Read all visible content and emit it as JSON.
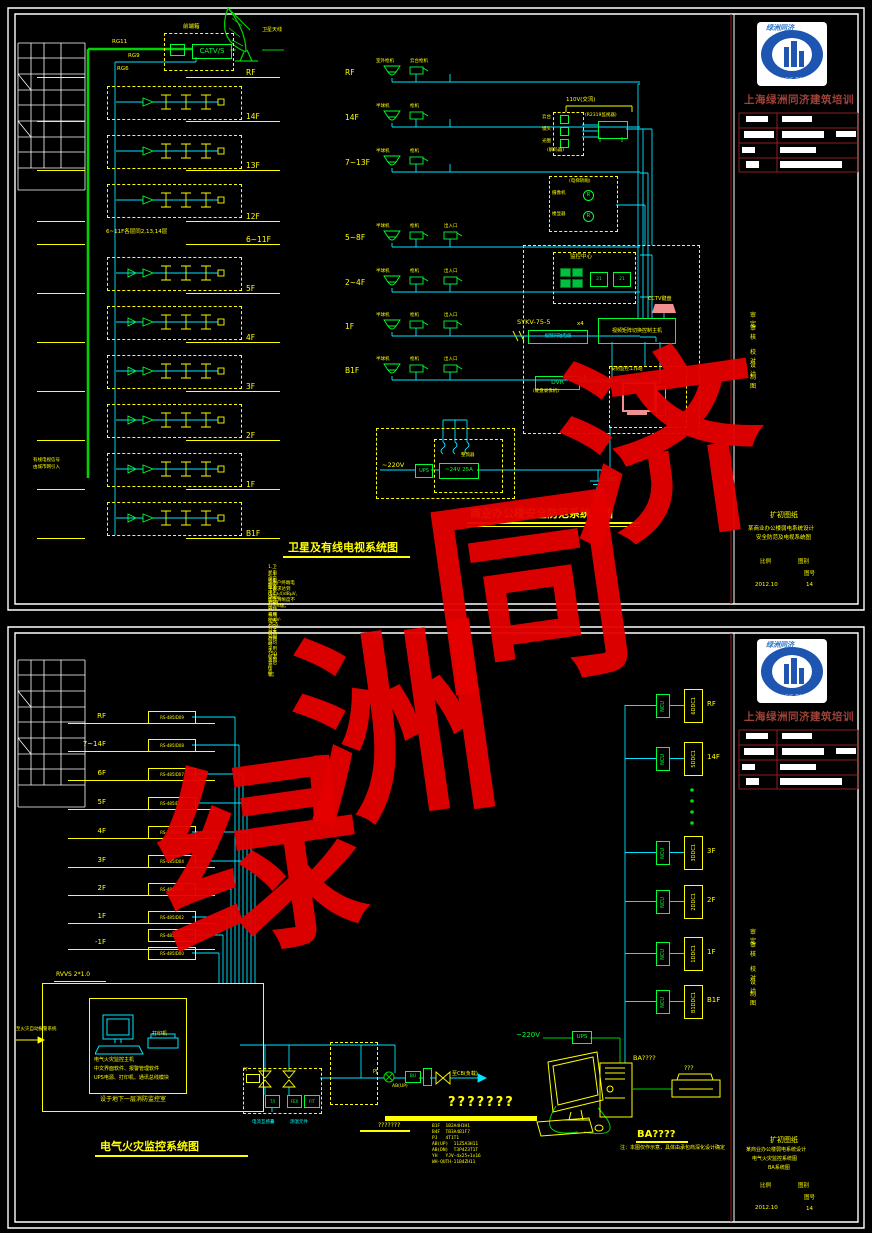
{
  "company": "上海绿洲同济建筑培训",
  "logo": {
    "script_text": "绿洲同济",
    "arc_text": "OASIS TONGJI"
  },
  "tb": {
    "stage": "扩初图纸",
    "scale_label": "比例",
    "type_label": "图别",
    "no_label": "图号",
    "date": "2012.10",
    "page": "14"
  },
  "tb1": {
    "line1": "某商业办公楼弱电系统设计",
    "line2": "安全防范及电视系统图"
  },
  "tb2": {
    "line1": "某商业办公楼弱电系统设计",
    "line2": "电气火灾监控系统图",
    "line3": "BA系统图"
  },
  "tb_labels": [
    {
      "x": 750,
      "y": 310,
      "label": "审定"
    },
    {
      "x": 750,
      "y": 323,
      "label": "审核"
    },
    {
      "x": 750,
      "y": 347,
      "label": "校对"
    },
    {
      "x": 750,
      "y": 360,
      "label": "设计"
    },
    {
      "x": 750,
      "y": 372,
      "label": "制图"
    },
    {
      "x": 750,
      "y": 927,
      "label": "审定"
    },
    {
      "x": 750,
      "y": 940,
      "label": "审核"
    },
    {
      "x": 750,
      "y": 964,
      "label": "校对"
    },
    {
      "x": 750,
      "y": 977,
      "label": "设计"
    },
    {
      "x": 750,
      "y": 989,
      "label": "制图"
    }
  ],
  "logos": [
    {
      "y": 22
    },
    {
      "y": 639
    }
  ],
  "s1": {
    "catv": {
      "title": "卫星及有线电视系统图",
      "headend": "前端箱",
      "catv_box": "CATV/S",
      "antenna": "卫星天线",
      "cables": {
        "c1": "RG11",
        "c2": "RG9",
        "c3": "RG6"
      },
      "entry1": "有线电视信号",
      "entry2": "由城市网引入",
      "mid_note": "6~11F各层同2,13,14层",
      "floors": [
        {
          "y": 68,
          "label": "RF"
        },
        {
          "y": 112,
          "label": "14F"
        },
        {
          "y": 161,
          "label": "13F"
        },
        {
          "y": 212,
          "label": "12F"
        },
        {
          "y": 235,
          "label": "6~11F"
        },
        {
          "y": 284,
          "label": "5F"
        },
        {
          "y": 333,
          "label": "4F"
        },
        {
          "y": 382,
          "label": "3F"
        },
        {
          "y": 431,
          "label": "2F"
        },
        {
          "y": 480,
          "label": "1F"
        },
        {
          "y": 529,
          "label": "B1F"
        }
      ],
      "bands": [
        {
          "y": 86
        },
        {
          "y": 135
        },
        {
          "y": 184
        },
        {
          "y": 257,
          "amp": 1
        },
        {
          "y": 306,
          "amp": 1
        },
        {
          "y": 355,
          "amp": 1
        },
        {
          "y": 404,
          "amp": 1
        },
        {
          "y": 453,
          "amp": 1
        },
        {
          "y": 502,
          "amp": 1
        }
      ],
      "notes": [
        {
          "y": 564,
          "text": "1.卫星电视前端设于屋顶前端箱内,有线电视信号由市政网引入,经混合后传输。"
        },
        {
          "y": 572,
          "text": "2.干线电缆采用SYKV-75-9,支线采用SYKV-75-5,分支分配器均采用75Ω系列产品。"
        },
        {
          "y": 580,
          "text": "3.用户终端电平要求达到(64±4)dBμV,图像清晰度不低于4级。"
        }
      ]
    },
    "cctv": {
      "title": "商业办公楼安全防范系统框图",
      "rows": [
        {
          "y": 58,
          "label": "RF",
          "c1": "室外枪机",
          "c2": "云台枪机"
        },
        {
          "y": 103,
          "label": "14F",
          "c1": "半球机",
          "c2": "枪机"
        },
        {
          "y": 148,
          "label": "7~13F",
          "c1": "半球机",
          "c2": "枪机"
        },
        {
          "y": 223,
          "label": "5~8F",
          "c1": "半球机",
          "c2": "枪机",
          "c3": "出入口",
          "c3g": 1
        },
        {
          "y": 268,
          "label": "2~4F",
          "c1": "半球机",
          "c2": "枪机",
          "c3": "出入口",
          "c3g": 1
        },
        {
          "y": 312,
          "label": "1F",
          "c1": "半球机",
          "c2": "枪机",
          "c3": "出入口",
          "c3g": 1
        },
        {
          "y": 356,
          "label": "B1F",
          "c1": "半球机",
          "c2": "枪机",
          "c3": "出入口",
          "c3g": 1
        }
      ],
      "center": "监控中心",
      "m21": "21",
      "matrix": "视频矩阵切换控制主机",
      "kb": "CCTV键盘",
      "cable": "SYKV-75-5",
      "x4": "x4",
      "vcable": "视频同轴电缆",
      "dvr": "DVR",
      "dvr_sub": "(硬盘录像机)",
      "x8": "x8",
      "ws": "安防监控工作站",
      "v110": "110V(交流)",
      "tvnote": "(R2319监视器)",
      "d1": "云台",
      "d2": "镜头",
      "d3": "光圈",
      "decoder": "(解码器)",
      "lift": "(电梯轿厢)",
      "l1": "摄像机",
      "l2": "楼显器",
      "r": "R",
      "v220": "~220V",
      "ups": "UPS",
      "v24": "~24V 25A",
      "rect": "整流器",
      "ground": "MEB"
    }
  },
  "s2": {
    "fire": {
      "title": "电气火灾监控系统图",
      "floors": [
        {
          "y": 712,
          "label": "RF"
        },
        {
          "y": 740,
          "label": "7~14F"
        },
        {
          "y": 769,
          "label": "6F"
        },
        {
          "y": 798,
          "label": "5F"
        },
        {
          "y": 827,
          "label": "4F"
        },
        {
          "y": 856,
          "label": "3F"
        },
        {
          "y": 884,
          "label": "2F"
        },
        {
          "y": 912,
          "label": "1F"
        },
        {
          "y": 938,
          "label": "-1F"
        }
      ],
      "detectors": [
        {
          "y": 711,
          "code": "RS-485ID09"
        },
        {
          "y": 739,
          "code": "RS-485ID08"
        },
        {
          "y": 768,
          "code": "RS-485ID07"
        },
        {
          "y": 797,
          "code": "RS-485ID06"
        },
        {
          "y": 826,
          "code": "RS-485ID05"
        },
        {
          "y": 855,
          "code": "RS-485ID04"
        },
        {
          "y": 883,
          "code": "RS-485ID03"
        },
        {
          "y": 911,
          "code": "RS-485ID02"
        },
        {
          "y": 929,
          "code": "RS-485ID01"
        },
        {
          "y": 947,
          "code": "RS-485ID00"
        }
      ],
      "cable": "RVVS 2*1.0",
      "fas": "至火灾自动报警系统",
      "printer": "打印机",
      "h1": "电气火灾监控主机",
      "h2": "中文界面软件、报警管理软件",
      "h3": "UPS电源、打印机、通讯总线模块",
      "caption": "设于地下一层消防监控室",
      "pt": "PT",
      "b1": "T/I",
      "b2": "FEX",
      "b3": "FIT",
      "ct": "电流互感器",
      "temp": "测温元件",
      "pj": "PJ",
      "bu": "BU",
      "abup": "AB(UP)",
      "load": "至CB(负载)",
      "qbig": "???????",
      "qsmall": "???????",
      "legend": [
        {
          "y": 1124,
          "text": "B1F  1B2A4H1H1"
        },
        {
          "y": 1130,
          "text": "B4F  TB3A4B1F7"
        },
        {
          "y": 1136,
          "text": "PJ   4T1T1"
        },
        {
          "y": 1142,
          "text": "AB(UP)  11Z5A3H11"
        },
        {
          "y": 1148,
          "text": "AB(DN)  T3P4Z3T1T"
        },
        {
          "y": 1154,
          "text": "YH   YJV-4x25+1x16"
        },
        {
          "y": 1160,
          "text": "WH-QUTH-11B4ZH11"
        }
      ]
    },
    "ba": {
      "rows": [
        {
          "y": 689,
          "floor": "RF",
          "ddc": "6DDC1"
        },
        {
          "y": 742,
          "floor": "14F",
          "ddc": "5DDC1"
        },
        {
          "y": 836,
          "floor": "3F",
          "ddc": "3DDC1"
        },
        {
          "y": 885,
          "floor": "2F",
          "ddc": "2DDC1"
        },
        {
          "y": 937,
          "floor": "1F",
          "ddc": "1DDC1"
        },
        {
          "y": 985,
          "floor": "B1F",
          "ddc": "B1DDC1"
        }
      ],
      "ncu": "NCU",
      "v220": "~220V",
      "ups": "UPS",
      "host": "BA????",
      "pq": "???",
      "title": "BA????",
      "note": "注：本图仅作示意，具体由承包商深化设计确定"
    }
  },
  "watermark": [
    {
      "ch": "济",
      "x": 560,
      "y": 350
    },
    {
      "ch": "同",
      "x": 428,
      "y": 492
    },
    {
      "ch": "洲",
      "x": 293,
      "y": 628
    },
    {
      "ch": "绿",
      "x": 158,
      "y": 760
    }
  ]
}
